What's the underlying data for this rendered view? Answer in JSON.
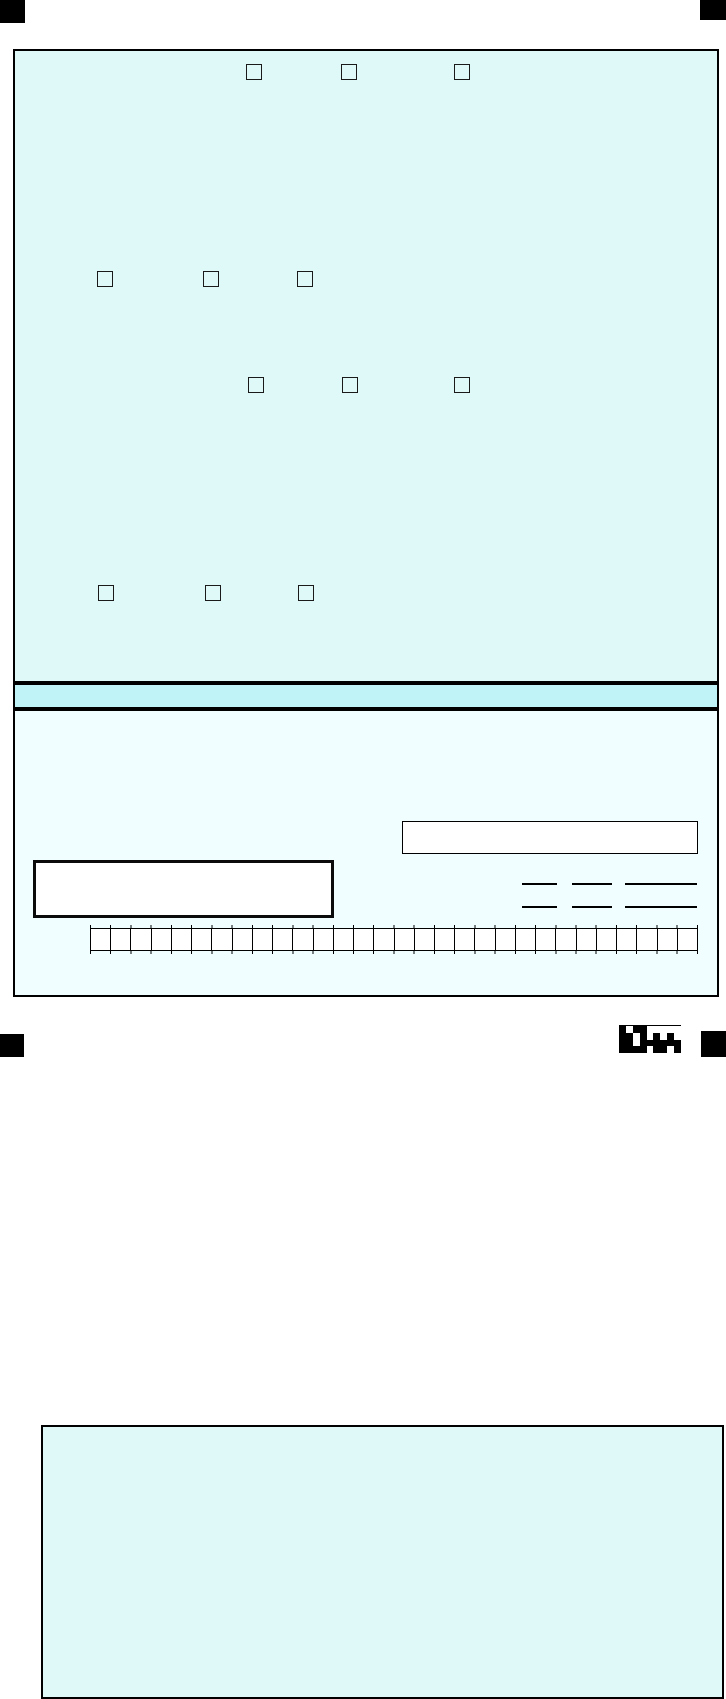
{
  "form": {
    "colors": {
      "panel_fill": "#DFF9F9",
      "strip_fill": "#BFF3F7",
      "outer_ring_fill": "#F0FEFF",
      "field_fill": "#FFFFFF",
      "line": "#000000"
    },
    "registration_marks": [
      {
        "name": "top-left",
        "x": 0,
        "y": 0,
        "w": 25,
        "h": 23
      },
      {
        "name": "top-right",
        "x": 700,
        "y": 0,
        "w": 26,
        "h": 20
      },
      {
        "name": "bottom-left",
        "x": 0,
        "y": 1034,
        "w": 24,
        "h": 23
      },
      {
        "name": "bottom-right",
        "x": 701,
        "y": 1031,
        "w": 25,
        "h": 26
      }
    ],
    "checkbox_size": 16,
    "checkbox_rows": [
      {
        "y": 64,
        "xs": [
          246,
          341,
          454
        ]
      },
      {
        "y": 271,
        "xs": [
          97,
          203,
          297
        ]
      },
      {
        "y": 377,
        "xs": [
          248,
          342,
          454
        ]
      },
      {
        "y": 585,
        "xs": [
          98,
          205,
          298
        ]
      }
    ],
    "underline_rows": [
      883,
      906
    ],
    "underline_segments": [
      {
        "x": 522,
        "w": 35
      },
      {
        "x": 572,
        "w": 40
      },
      {
        "x": 625,
        "w": 72
      }
    ],
    "comb": {
      "cells": 30
    },
    "barcode_rows": [
      "101100000",
      "110101010",
      "110111111",
      "111101101"
    ]
  }
}
